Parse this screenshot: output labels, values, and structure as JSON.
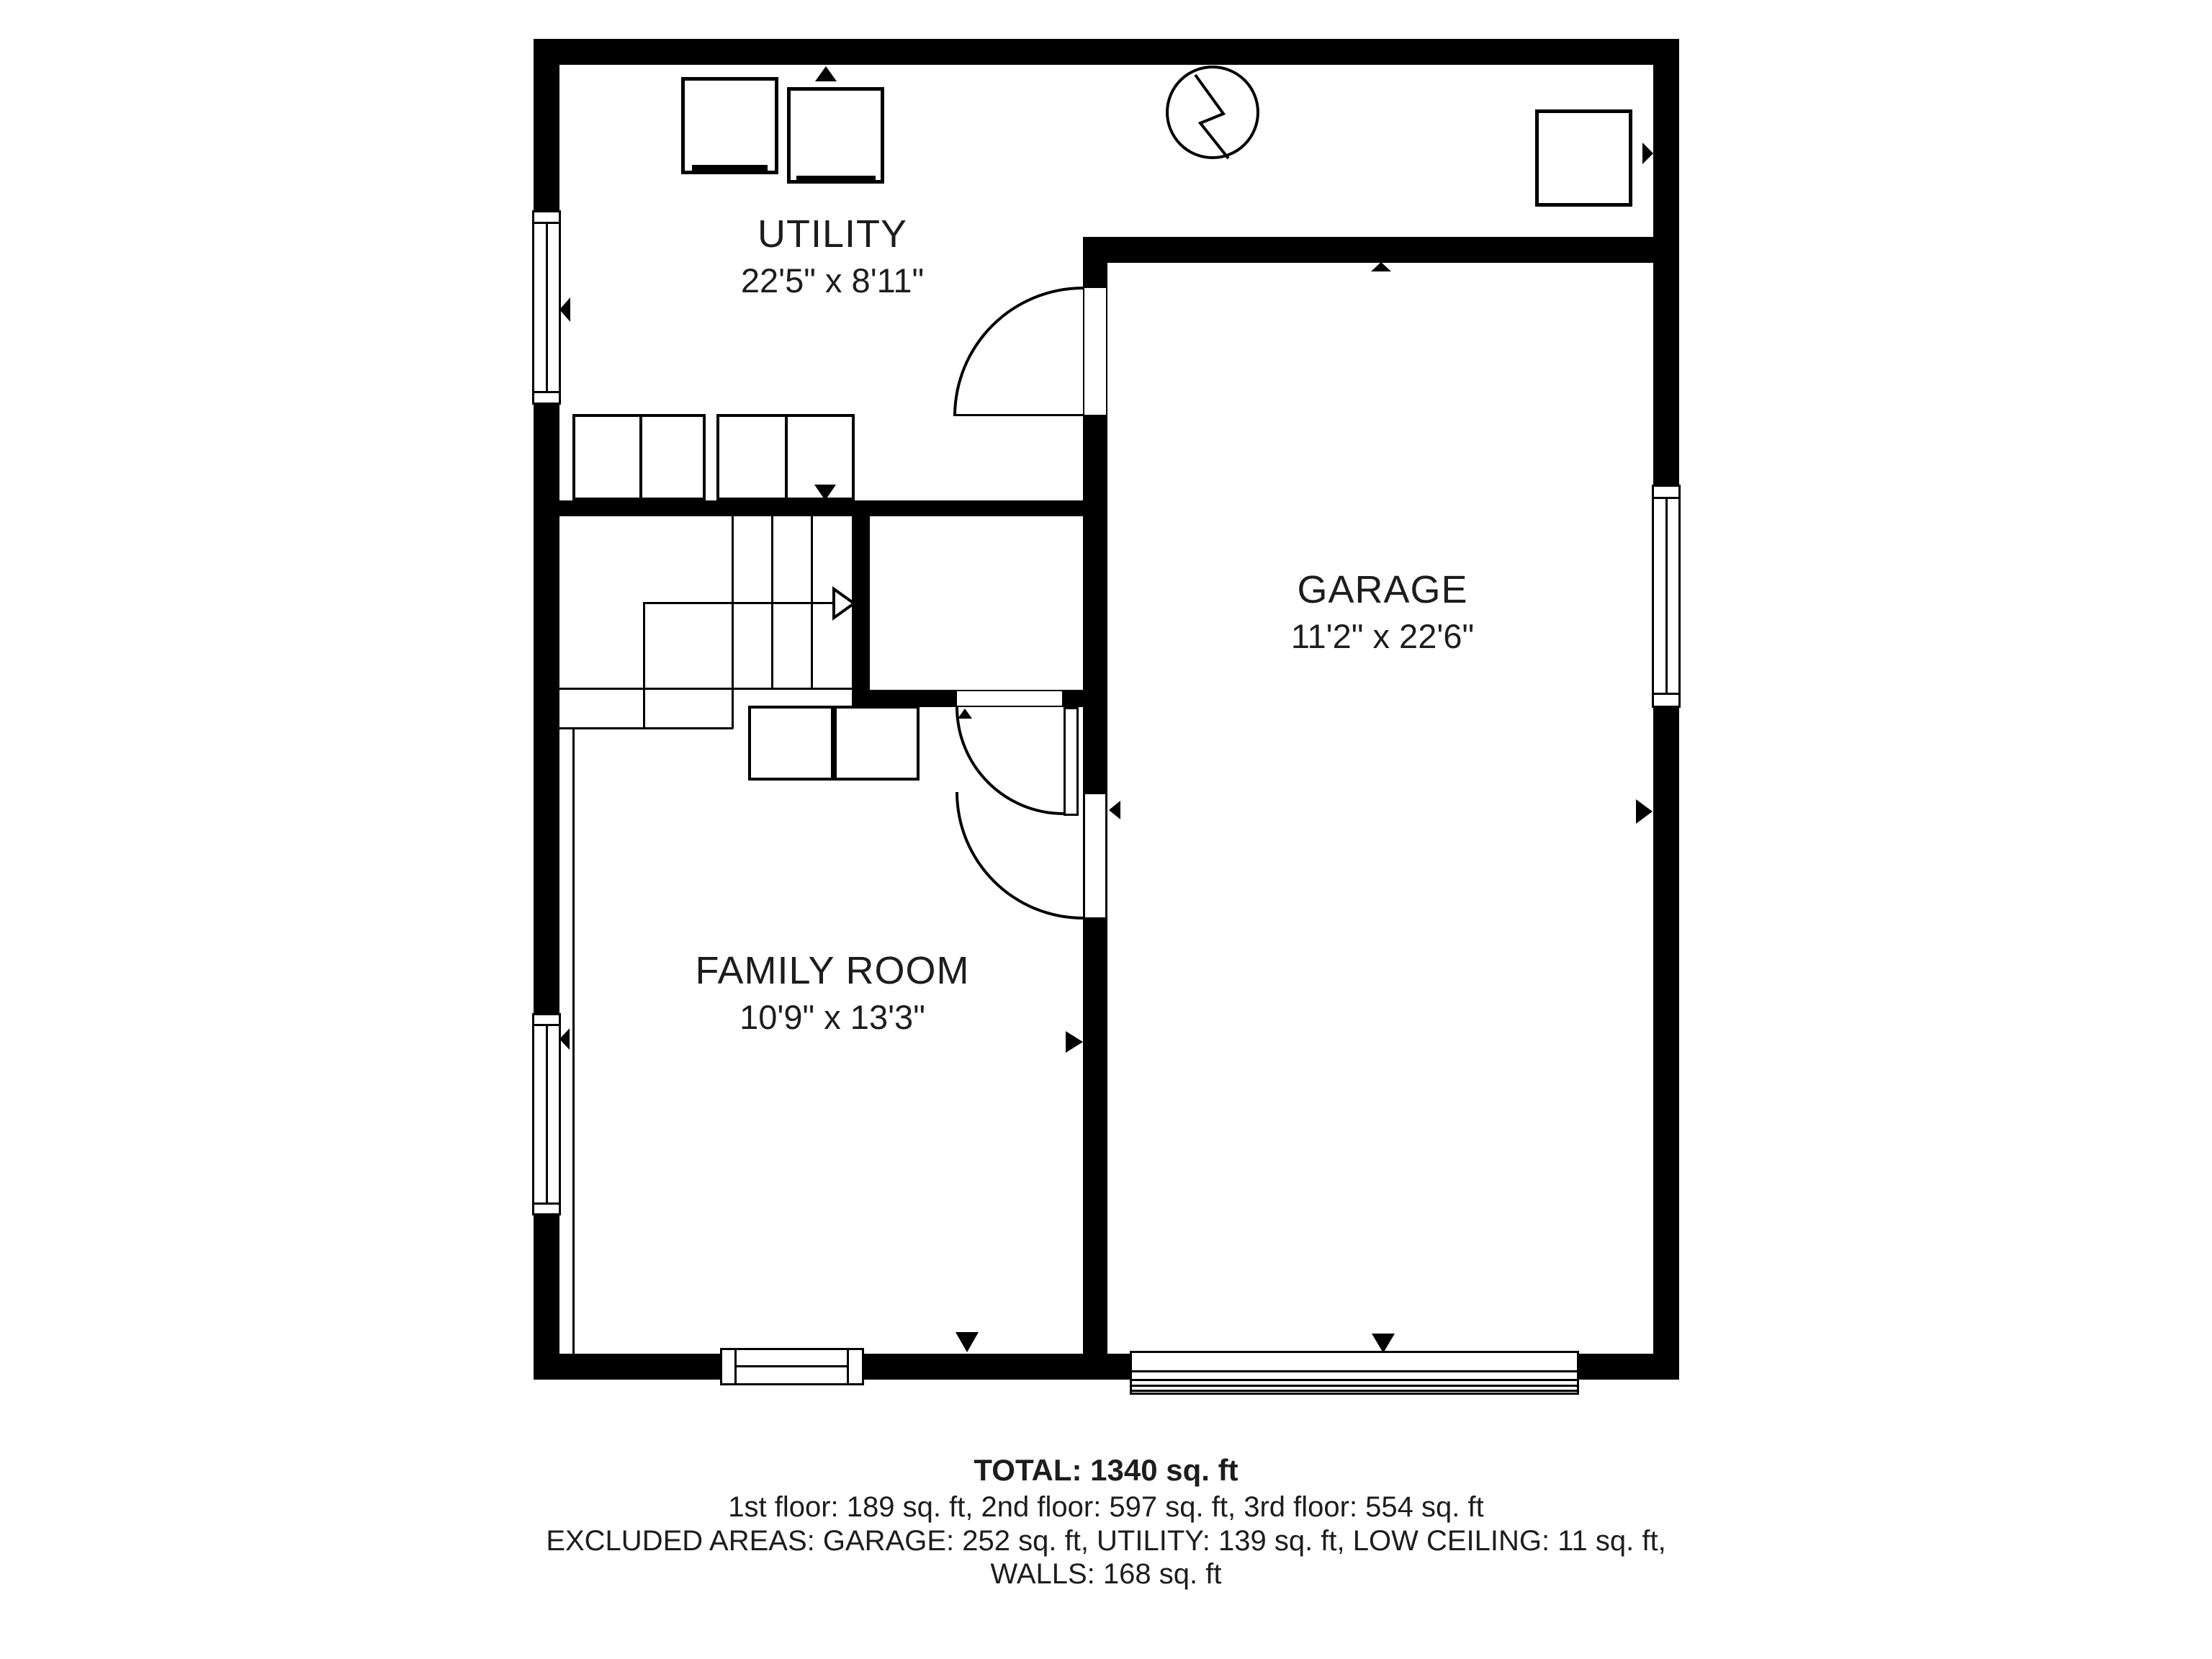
{
  "colors": {
    "background": "#ffffff",
    "walls": "#000000",
    "text": "#1d1d1d"
  },
  "rooms": [
    {
      "id": "utility",
      "label": "UTILITY",
      "dimensions": "22'5\" x 8'11\""
    },
    {
      "id": "garage",
      "label": "GARAGE",
      "dimensions": "11'2\" x 22'6\""
    },
    {
      "id": "family-room",
      "label": "FAMILY ROOM",
      "dimensions": "10'9\" x 13'3\""
    }
  ],
  "summary": {
    "total": "TOTAL: 1340 sq. ft",
    "floors": "1st floor: 189 sq. ft, 2nd floor: 597 sq. ft, 3rd floor: 554 sq. ft",
    "excluded_areas": "EXCLUDED AREAS: GARAGE: 252 sq. ft, UTILITY: 139 sq. ft, LOW CEILING: 11 sq. ft,",
    "walls": "WALLS: 168 sq. ft"
  },
  "fixtures": [
    "washer",
    "dryer",
    "electrical-meter",
    "water-heater",
    "cabinets",
    "staircase",
    "garage-door",
    "windows",
    "doors"
  ]
}
